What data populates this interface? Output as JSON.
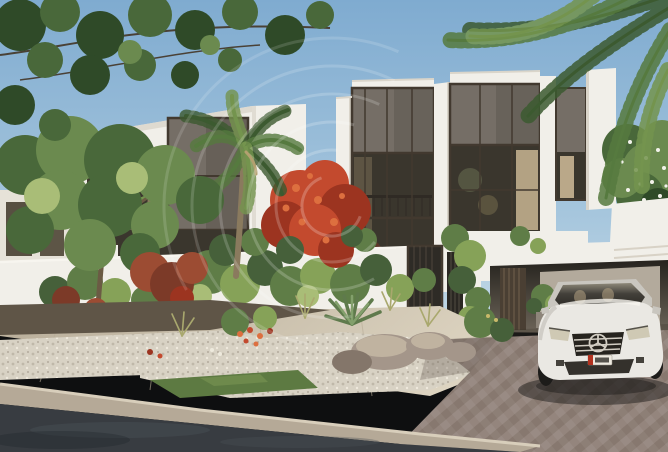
{
  "meta": {
    "type": "architectural-exterior-rendering",
    "alt": "Photorealistic rendering of modern white two-storey villas with dark bronze-framed glazing, a landscaped front garden with palms, red bougainvillea and rock beds, a white garden wall with a dark mesh gate, a carport with a white Mercedes sedan on brick paving, and an asphalt road in the foreground. A faint circular arc logo watermark overlays the center.",
    "watermark": "faint concentric-arc swirl logo, centered over the facade",
    "license_plate": "illegible red-and-white UAE style plate on car front bumper"
  },
  "colors": {
    "sky_top": "#7fabd0",
    "sky_mid": "#a6c6dd",
    "sky_low": "#c4d9e7",
    "villa_white": "#f1efe9",
    "villa_shade": "#d9d4c9",
    "panel_grey": "#756e66",
    "panel_grey_dark": "#5b554d",
    "frame_bronze": "#42392f",
    "glass_dark": "#3a362d",
    "glass_warm": "#8a7a5f",
    "curtain": "#c9b593",
    "creeper_dark": "#46603a",
    "creeper_mid": "#5f7d47",
    "creeper_light": "#86a258",
    "creeper_pale": "#a9bd77",
    "palm_dark": "#3c5a30",
    "palm_mid": "#567a3f",
    "palm_light": "#74944e",
    "tree_dark": "#2f4a28",
    "tree_mid": "#49683a",
    "tree_light": "#6b8a4f",
    "flower_red": "#c34a2e",
    "flower_red_dark": "#9c3420",
    "flower_orange": "#dd6f3f",
    "rust": "#9c4c33",
    "rust_dark": "#7c3a28",
    "trunk": "#8a7a5e",
    "trunk_dark": "#6b5b44",
    "pave": "#cfc5b2",
    "pave_light": "#ded5c2",
    "pave_shade": "#b7ac97",
    "drive_base": "#94857d",
    "drive_alt": "#87786f",
    "gravel": "#d8d2c4",
    "gravel_dot": "#bfb8a9",
    "grass": "#5d7a42",
    "grass_light": "#7a9454",
    "rock": "#a4968a",
    "rock_light": "#c0b3a0",
    "rock_dark": "#84766a",
    "curb": "#b5a997",
    "curb_light": "#d8cebb",
    "road": "#383c41",
    "road_light": "#4a5056",
    "car_body": "#eae8e3",
    "car_shade": "#c9c6bf",
    "grille": "#26231e",
    "chrome": "#d2cdc3",
    "tire": "#1d1c1a",
    "plate_white": "#eeeae0",
    "plate_red": "#b2321f",
    "interior_wall": "#b3aa9c",
    "door_slat": "#4a3f33",
    "watermark_white": "#ffffff"
  }
}
